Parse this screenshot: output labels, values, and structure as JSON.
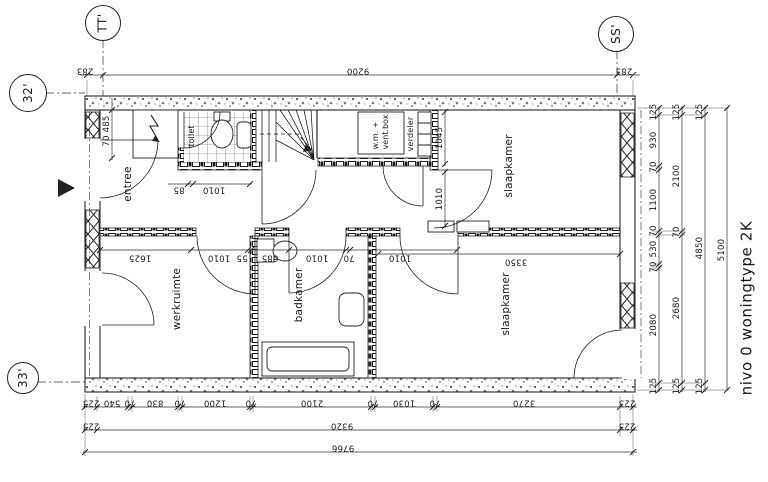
{
  "title": "nivo 0 woningtype 2K",
  "axis_markers": {
    "tt": "TT'",
    "ss": "SS'",
    "m32": "32'",
    "m33": "33'"
  },
  "rooms": {
    "entree": "entree",
    "toilet": "toilet",
    "werkruimte": "werkruimte",
    "badkamer": "badkamer",
    "slaapkamer_top": "slaapkamer",
    "slaapkamer_bottom": "slaapkamer"
  },
  "equipment": {
    "wm_line1": "w.m. +",
    "wm_line2": "vent.box",
    "verdeler": "verdeler"
  },
  "dims": {
    "top": [
      "283",
      "9200",
      "283"
    ],
    "right1": [
      "125",
      "930",
      "70",
      "1100",
      "70",
      "530",
      "70",
      "2080",
      "125"
    ],
    "right2": [
      "125",
      "2100",
      "70",
      "2680",
      "125"
    ],
    "right3": [
      "125",
      "4850",
      "125"
    ],
    "right4": [
      "5100"
    ],
    "bottom1": [
      "223",
      "540",
      "70",
      "830",
      "70",
      "1200",
      "70",
      "2100",
      "70",
      "1030",
      "70",
      "3270",
      "223"
    ],
    "bottom2": [
      "223",
      "9320",
      "223"
    ],
    "bottom3": [
      "9766"
    ],
    "interior": {
      "mk": "70 485",
      "hall_a": "85",
      "hall_b": "1010",
      "closet": "1045",
      "door_top": "1010",
      "werk_a": "1625",
      "werk_b": "1010",
      "werk_c": "55",
      "bad_a": "685",
      "bad_b": "1010",
      "bad_wall": "70",
      "bad_c": "1010",
      "slaap_w": "3350"
    }
  }
}
